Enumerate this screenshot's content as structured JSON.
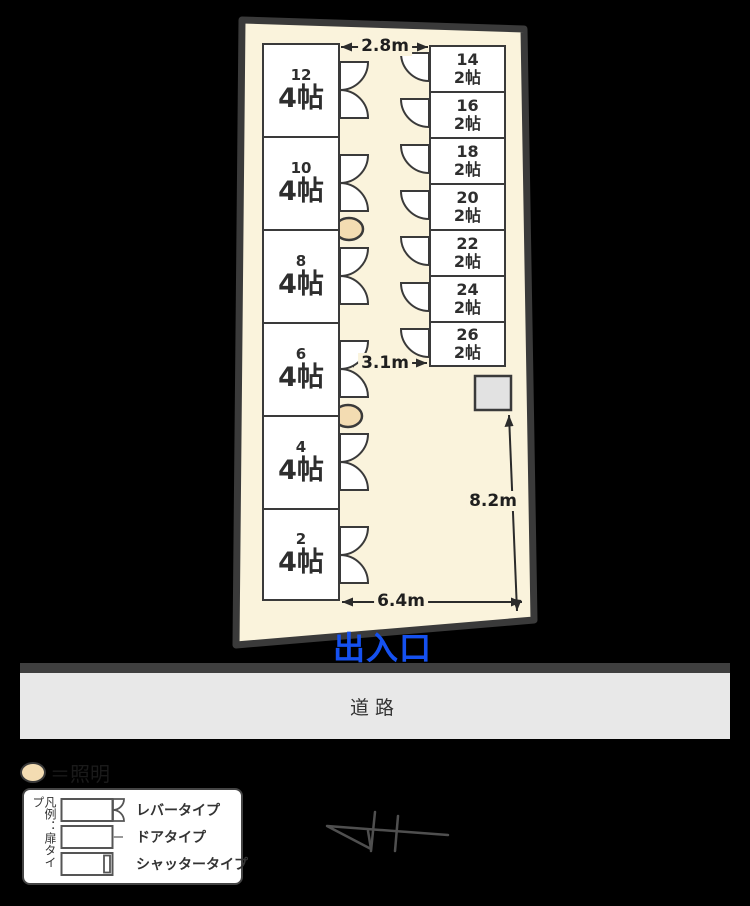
{
  "plan": {
    "units_left": [
      {
        "number": "12",
        "size": "4帖"
      },
      {
        "number": "10",
        "size": "4帖"
      },
      {
        "number": "8",
        "size": "4帖"
      },
      {
        "number": "6",
        "size": "4帖"
      },
      {
        "number": "4",
        "size": "4帖"
      },
      {
        "number": "2",
        "size": "4帖"
      }
    ],
    "units_right": [
      {
        "number": "14",
        "size": "2帖"
      },
      {
        "number": "16",
        "size": "2帖"
      },
      {
        "number": "18",
        "size": "2帖"
      },
      {
        "number": "20",
        "size": "2帖"
      },
      {
        "number": "22",
        "size": "2帖"
      },
      {
        "number": "24",
        "size": "2帖"
      },
      {
        "number": "26",
        "size": "2帖"
      }
    ],
    "measurements": {
      "top_width": "2.8m",
      "middle_width": "3.1m",
      "right_height": "8.2m",
      "bottom_width": "6.4m"
    },
    "entrance_label": "出入口"
  },
  "road": {
    "label": "道路"
  },
  "legend": {
    "light_label": "＝照明",
    "door_title": "凡例：扉タイプ",
    "items": [
      {
        "label": "レバータイプ"
      },
      {
        "label": "ドアタイプ"
      },
      {
        "label": "シャッタータイプ"
      }
    ]
  },
  "colors": {
    "background": "#000000",
    "site_fill": "#faf3dc",
    "outline": "#3a3a3a",
    "entrance_blue": "#1551f0",
    "road_fill": "#e8e8e8",
    "light_fill": "#f3dcb2"
  }
}
